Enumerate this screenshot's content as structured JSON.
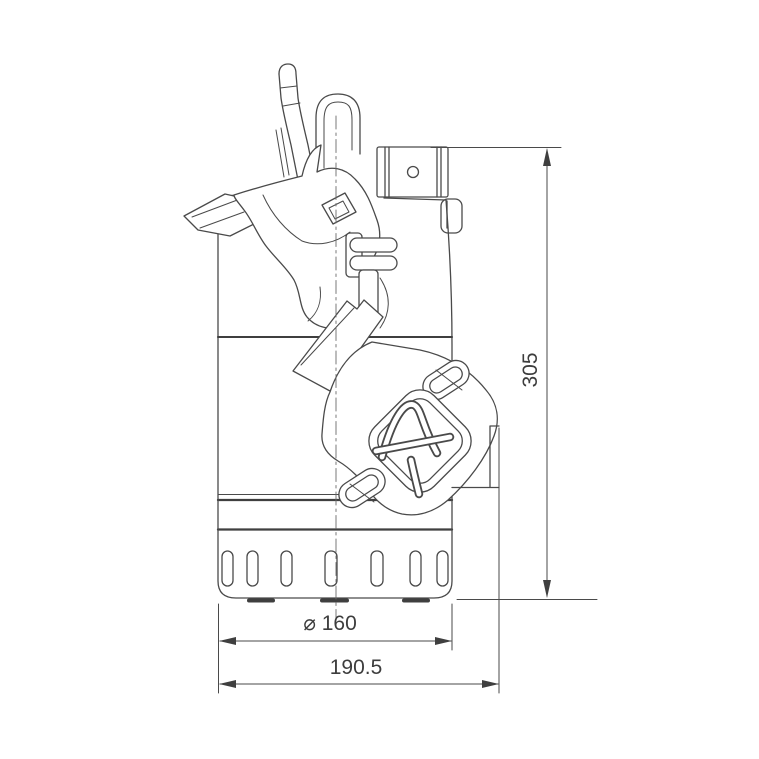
{
  "drawing": {
    "subject": "submersible-pump-dimensional-drawing",
    "view": "side elevation",
    "background": "#ffffff",
    "line_color": "#4a4a4a",
    "text_color": "#3d3d3d",
    "dimensions": {
      "height": "305",
      "diameter": "⌀ 160",
      "width": "190.5"
    },
    "icons": {
      "brand_logo": "x-logo-in-rounded-diamond"
    }
  }
}
